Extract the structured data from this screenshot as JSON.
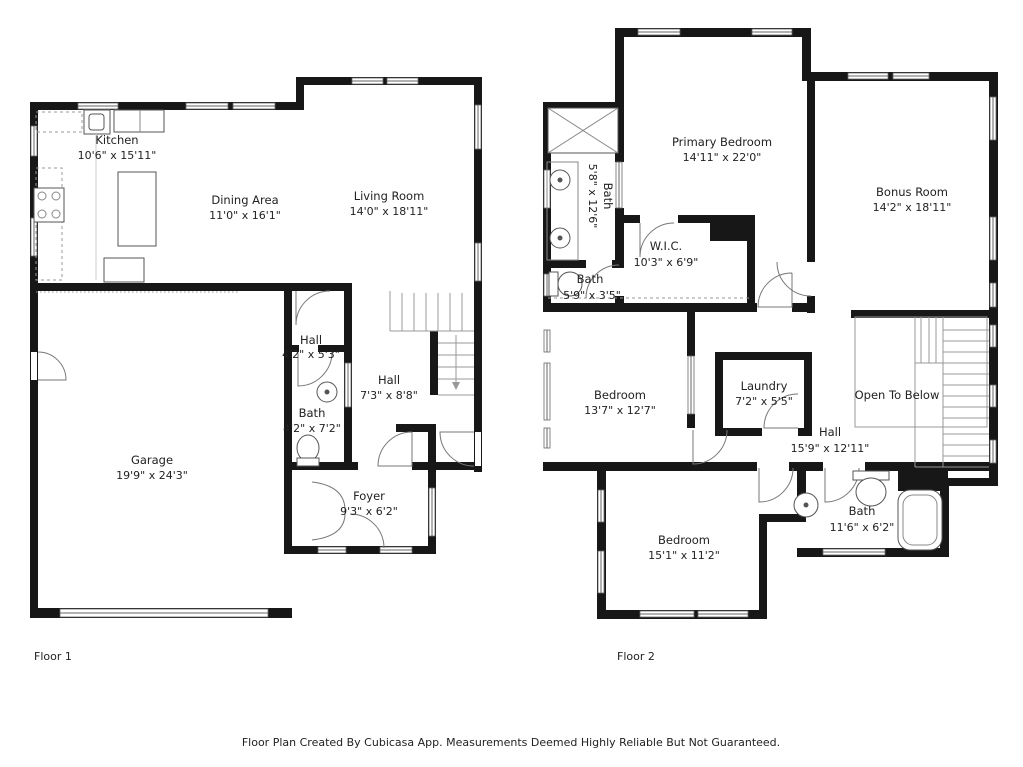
{
  "title": "Floor Plan",
  "footer": "Floor Plan Created By Cubicasa App. Measurements Deemed Highly Reliable But Not Guaranteed.",
  "floor1": {
    "label": "Floor 1",
    "rooms": {
      "kitchen": {
        "name": "Kitchen",
        "dims": "10'6\" x 15'11\""
      },
      "dining": {
        "name": "Dining Area",
        "dims": "11'0\" x 16'1\""
      },
      "living": {
        "name": "Living Room",
        "dims": "14'0\" x 18'11\""
      },
      "hall_small": {
        "name": "Hall",
        "dims": "4'2\" x 5'3\""
      },
      "bath": {
        "name": "Bath",
        "dims": "4'2\" x 7'2\""
      },
      "hall": {
        "name": "Hall",
        "dims": "7'3\" x 8'8\""
      },
      "garage": {
        "name": "Garage",
        "dims": "19'9\" x 24'3\""
      },
      "foyer": {
        "name": "Foyer",
        "dims": "9'3\" x 6'2\""
      }
    }
  },
  "floor2": {
    "label": "Floor 2",
    "rooms": {
      "primary": {
        "name": "Primary Bedroom",
        "dims": "14'11\" x 22'0\""
      },
      "bath_ens": {
        "name": "Bath",
        "dims": "5'8\" x 12'6\""
      },
      "wic": {
        "name": "W.I.C.",
        "dims": "10'3\" x 6'9\""
      },
      "bath_small": {
        "name": "Bath",
        "dims": "5'9\" x 3'5\""
      },
      "bonus": {
        "name": "Bonus Room",
        "dims": "14'2\" x 18'11\""
      },
      "bedroom1": {
        "name": "Bedroom",
        "dims": "13'7\" x 12'7\""
      },
      "laundry": {
        "name": "Laundry",
        "dims": "7'2\" x 5'5\""
      },
      "hall": {
        "name": "Hall",
        "dims": "15'9\" x 12'11\""
      },
      "open_below": {
        "name": "Open To Below",
        "dims": ""
      },
      "bedroom2": {
        "name": "Bedroom",
        "dims": "15'1\" x 11'2\""
      },
      "bath_hall": {
        "name": "Bath",
        "dims": "11'6\" x 6'2\""
      }
    }
  }
}
